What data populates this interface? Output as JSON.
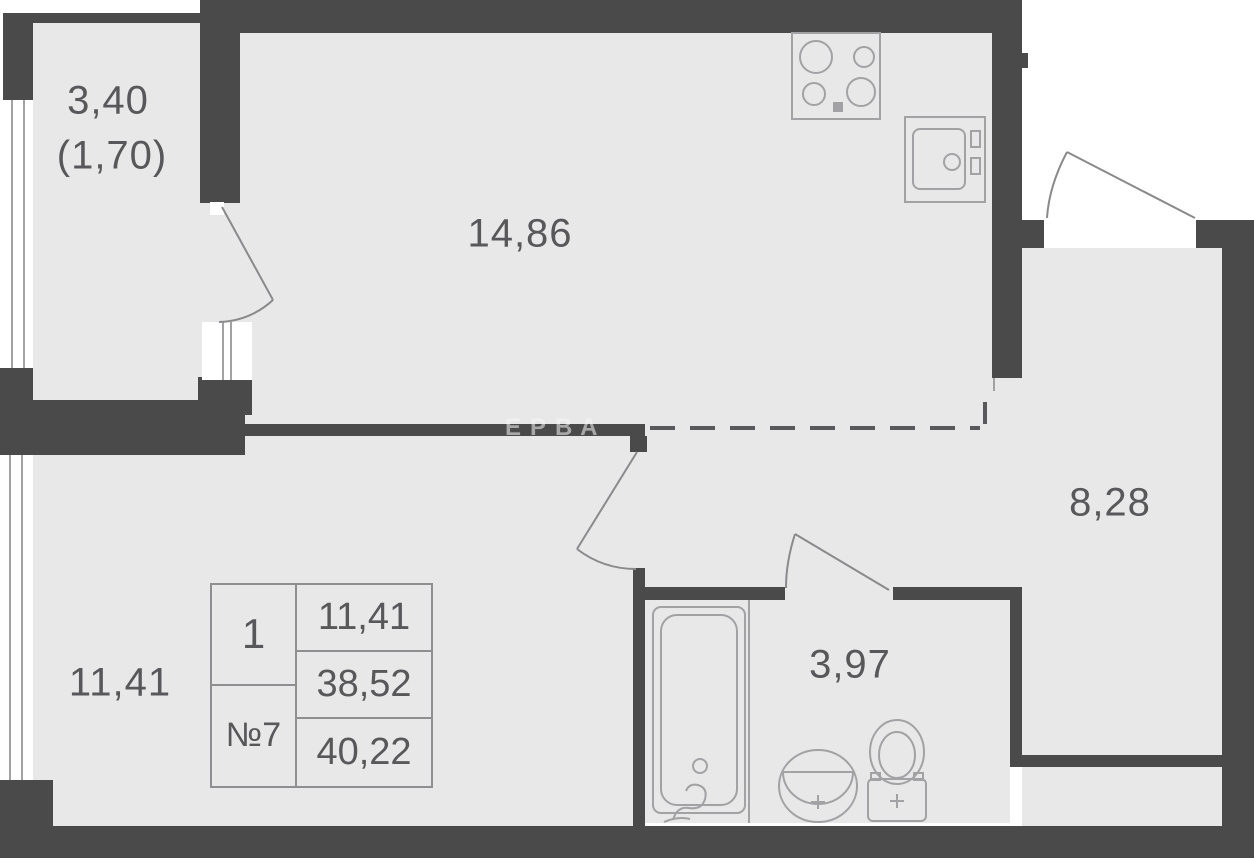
{
  "plan_labels": {
    "balcony_area": "3,40",
    "balcony_area_reduced": "(1,70)",
    "kitchen_living_area": "14,86",
    "hallway_area": "8,28",
    "room_area": "11,41",
    "bathroom_area": "3,97"
  },
  "stamp": {
    "rooms_count": "1",
    "apartment_number": "№7",
    "living_area": "11,41",
    "total_area_no_summer": "38,52",
    "total_area": "40,22"
  },
  "watermark_fragment": "ЕРВА",
  "icons": [
    "stove-icon",
    "kitchen-sink-icon",
    "bathtub-icon",
    "washbasin-icon",
    "toilet-icon",
    "balcony-door-swing-icon",
    "bedroom-door-swing-icon",
    "bathroom-door-swing-icon",
    "entrance-door-swing-icon",
    "dashed-boundary-icon",
    "window-icon"
  ],
  "colors": {
    "background": "#ffffff",
    "wall": "#4a4a4b",
    "floor": "#e8e8e9",
    "outline": "#a2a2a4",
    "line": "#8a8a8c",
    "text": "#58585a",
    "stamp_border": "#8f8f91",
    "dash": "#59595b"
  }
}
